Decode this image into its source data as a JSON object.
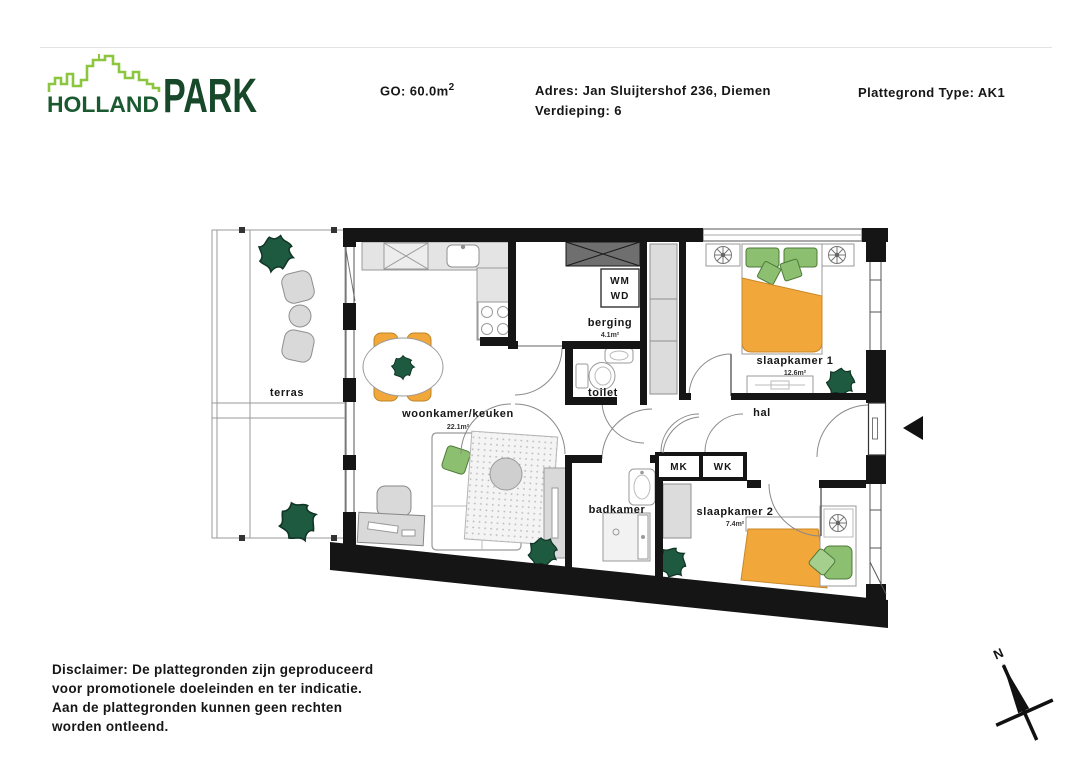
{
  "header": {
    "logo": {
      "holland": "HOLLAND",
      "park": "PARK"
    },
    "go_label": "GO: 60.0m",
    "go_sup": "2",
    "address_label": "Adres: Jan Sluijtershof 236, Diemen",
    "floor_label": "Verdieping: 6",
    "type_label": "Plattegrond Type: AK1"
  },
  "floorplan": {
    "rooms": [
      {
        "id": "terras",
        "label": "terras",
        "area": ""
      },
      {
        "id": "woonkamer",
        "label": "woonkamer/keuken",
        "area": "22.1m²"
      },
      {
        "id": "berging",
        "label": "berging",
        "area": "4.1m²"
      },
      {
        "id": "toilet",
        "label": "toilet",
        "area": ""
      },
      {
        "id": "slaapkamer1",
        "label": "slaapkamer 1",
        "area": "12.6m²"
      },
      {
        "id": "hal",
        "label": "hal",
        "area": ""
      },
      {
        "id": "badkamer",
        "label": "badkamer",
        "area": ""
      },
      {
        "id": "slaapkamer2",
        "label": "slaapkamer 2",
        "area": "7.4m²"
      }
    ],
    "boxes": {
      "wm": "WM",
      "wd": "WD",
      "mk": "MK",
      "wk": "WK"
    },
    "compass_label": "N"
  },
  "disclaimer": {
    "lines": [
      "Disclaimer: De plattegronden zijn geproduceerd",
      "voor promotionele doeleinden en ter indicatie.",
      "Aan de plattegronden kunnen geen rechten",
      "worden ontleend."
    ]
  },
  "colors": {
    "wall": "#151515",
    "furniture_orange": "#f2a73b",
    "furniture_green": "#8cc070",
    "plant_green": "#1e5a40",
    "logo_light_green": "#8cc63f",
    "logo_dark_green": "#1b5a30"
  }
}
